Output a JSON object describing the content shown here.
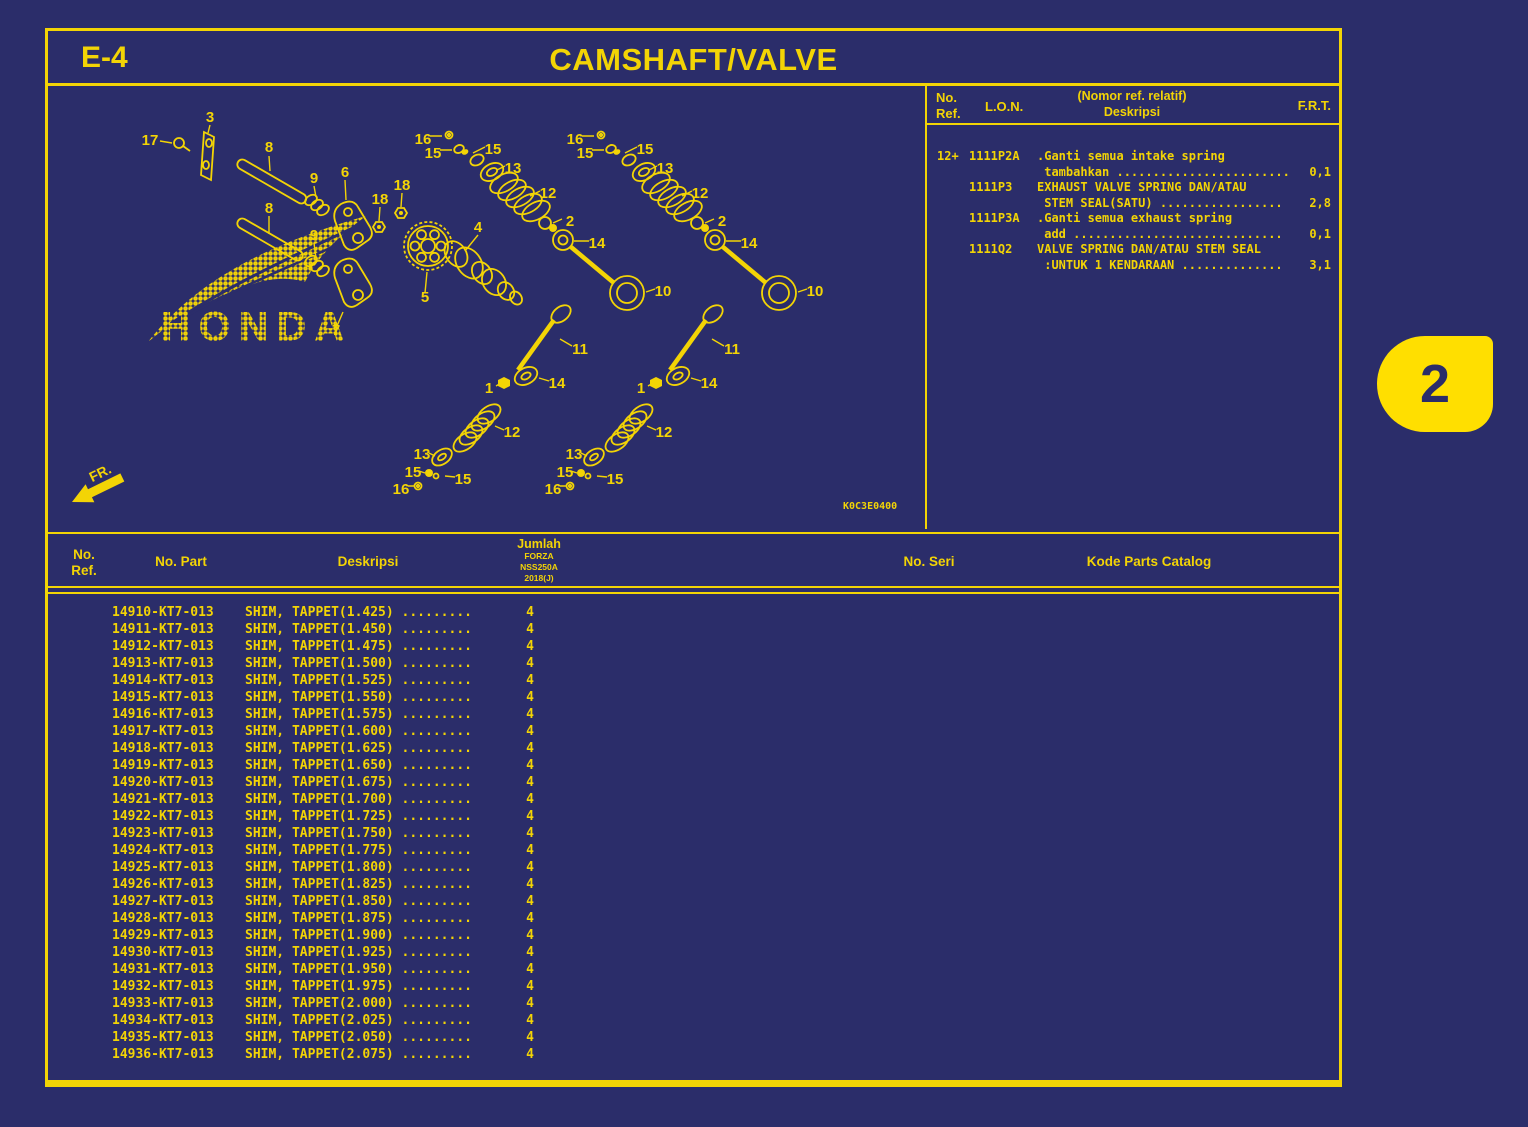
{
  "page": {
    "code": "E-4",
    "title": "CAMSHAFT/VALVE",
    "diagram_code": "K0C3E0400",
    "fr_label": "FR.",
    "tab_number": "2",
    "watermark": "HONDA"
  },
  "colors": {
    "background": "#2b2d6a",
    "line_yellow": "#f3d405",
    "tab_yellow": "#ffdf00"
  },
  "lon_table": {
    "headers": {
      "no": "No.",
      "ref": "Ref.",
      "lon": "L.O.N.",
      "desk1": "(Nomor ref. relatif)",
      "desk2": "Deskripsi",
      "frt": "F.R.T."
    },
    "rows": [
      {
        "ref": "12+",
        "lon": "1111P2A",
        "line1": ".Ganti semua intake spring",
        "line2": " tambahkan ........................",
        "frt": "0,1"
      },
      {
        "ref": "",
        "lon": "1111P3",
        "line1": "EXHAUST VALVE SPRING DAN/ATAU",
        "line2": " STEM SEAL(SATU) .................",
        "frt": "2,8"
      },
      {
        "ref": "",
        "lon": "1111P3A",
        "line1": ".Ganti semua exhaust spring",
        "line2": " add .............................",
        "frt": "0,1"
      },
      {
        "ref": "",
        "lon": "1111Q2",
        "line1": "VALVE SPRING DAN/ATAU STEM SEAL",
        "line2": " :UNTUK 1 KENDARAAN ..............",
        "frt": "3,1"
      }
    ]
  },
  "parts_table": {
    "headers": {
      "no": "No.",
      "ref": "Ref.",
      "part": "No. Part",
      "desk": "Deskripsi",
      "jumlah": "Jumlah",
      "model1": "FORZA",
      "model2": "NSS250A",
      "model3": "2018(J)",
      "seri": "No. Seri",
      "kode": "Kode Parts Catalog"
    },
    "rows": [
      {
        "part": "14910-KT7-013",
        "desc": "SHIM, TAPPET(1.425)",
        "dots": ".........",
        "qty": "4"
      },
      {
        "part": "14911-KT7-013",
        "desc": "SHIM, TAPPET(1.450)",
        "dots": ".........",
        "qty": "4"
      },
      {
        "part": "14912-KT7-013",
        "desc": "SHIM, TAPPET(1.475)",
        "dots": ".........",
        "qty": "4"
      },
      {
        "part": "14913-KT7-013",
        "desc": "SHIM, TAPPET(1.500)",
        "dots": ".........",
        "qty": "4"
      },
      {
        "part": "14914-KT7-013",
        "desc": "SHIM, TAPPET(1.525)",
        "dots": ".........",
        "qty": "4"
      },
      {
        "part": "14915-KT7-013",
        "desc": "SHIM, TAPPET(1.550)",
        "dots": ".........",
        "qty": "4"
      },
      {
        "part": "14916-KT7-013",
        "desc": "SHIM, TAPPET(1.575)",
        "dots": ".........",
        "qty": "4"
      },
      {
        "part": "14917-KT7-013",
        "desc": "SHIM, TAPPET(1.600)",
        "dots": ".........",
        "qty": "4"
      },
      {
        "part": "14918-KT7-013",
        "desc": "SHIM, TAPPET(1.625)",
        "dots": ".........",
        "qty": "4"
      },
      {
        "part": "14919-KT7-013",
        "desc": "SHIM, TAPPET(1.650)",
        "dots": ".........",
        "qty": "4"
      },
      {
        "part": "14920-KT7-013",
        "desc": "SHIM, TAPPET(1.675)",
        "dots": ".........",
        "qty": "4"
      },
      {
        "part": "14921-KT7-013",
        "desc": "SHIM, TAPPET(1.700)",
        "dots": ".........",
        "qty": "4"
      },
      {
        "part": "14922-KT7-013",
        "desc": "SHIM, TAPPET(1.725)",
        "dots": ".........",
        "qty": "4"
      },
      {
        "part": "14923-KT7-013",
        "desc": "SHIM, TAPPET(1.750)",
        "dots": ".........",
        "qty": "4"
      },
      {
        "part": "14924-KT7-013",
        "desc": "SHIM, TAPPET(1.775)",
        "dots": ".........",
        "qty": "4"
      },
      {
        "part": "14925-KT7-013",
        "desc": "SHIM, TAPPET(1.800)",
        "dots": ".........",
        "qty": "4"
      },
      {
        "part": "14926-KT7-013",
        "desc": "SHIM, TAPPET(1.825)",
        "dots": ".........",
        "qty": "4"
      },
      {
        "part": "14927-KT7-013",
        "desc": "SHIM, TAPPET(1.850)",
        "dots": ".........",
        "qty": "4"
      },
      {
        "part": "14928-KT7-013",
        "desc": "SHIM, TAPPET(1.875)",
        "dots": ".........",
        "qty": "4"
      },
      {
        "part": "14929-KT7-013",
        "desc": "SHIM, TAPPET(1.900)",
        "dots": ".........",
        "qty": "4"
      },
      {
        "part": "14930-KT7-013",
        "desc": "SHIM, TAPPET(1.925)",
        "dots": ".........",
        "qty": "4"
      },
      {
        "part": "14931-KT7-013",
        "desc": "SHIM, TAPPET(1.950)",
        "dots": ".........",
        "qty": "4"
      },
      {
        "part": "14932-KT7-013",
        "desc": "SHIM, TAPPET(1.975)",
        "dots": ".........",
        "qty": "4"
      },
      {
        "part": "14933-KT7-013",
        "desc": "SHIM, TAPPET(2.000)",
        "dots": ".........",
        "qty": "4"
      },
      {
        "part": "14934-KT7-013",
        "desc": "SHIM, TAPPET(2.025)",
        "dots": ".........",
        "qty": "4"
      },
      {
        "part": "14935-KT7-013",
        "desc": "SHIM, TAPPET(2.050)",
        "dots": ".........",
        "qty": "4"
      },
      {
        "part": "14936-KT7-013",
        "desc": "SHIM, TAPPET(2.075)",
        "dots": ".........",
        "qty": "4"
      }
    ]
  },
  "diagram": {
    "callouts": [
      {
        "t": "17",
        "x": 102,
        "y": 59
      },
      {
        "t": "3",
        "x": 162,
        "y": 36
      },
      {
        "t": "8",
        "x": 221,
        "y": 66
      },
      {
        "t": "8",
        "x": 221,
        "y": 127
      },
      {
        "t": "9",
        "x": 266,
        "y": 97
      },
      {
        "t": "9",
        "x": 266,
        "y": 154
      },
      {
        "t": "6",
        "x": 297,
        "y": 91
      },
      {
        "t": "18",
        "x": 332,
        "y": 118
      },
      {
        "t": "18",
        "x": 354,
        "y": 104
      },
      {
        "t": "7",
        "x": 288,
        "y": 249
      },
      {
        "t": "5",
        "x": 377,
        "y": 216
      },
      {
        "t": "4",
        "x": 430,
        "y": 146
      },
      {
        "t": "16",
        "x": 375,
        "y": 58
      },
      {
        "t": "15",
        "x": 385,
        "y": 72
      },
      {
        "t": "15",
        "x": 445,
        "y": 68
      },
      {
        "t": "13",
        "x": 465,
        "y": 87
      },
      {
        "t": "12",
        "x": 500,
        "y": 112
      },
      {
        "t": "2",
        "x": 522,
        "y": 140
      },
      {
        "t": "14",
        "x": 549,
        "y": 162
      },
      {
        "t": "10",
        "x": 615,
        "y": 210
      },
      {
        "t": "11",
        "x": 532,
        "y": 268
      },
      {
        "t": "14",
        "x": 509,
        "y": 302
      },
      {
        "t": "1",
        "x": 441,
        "y": 307
      },
      {
        "t": "12",
        "x": 464,
        "y": 351
      },
      {
        "t": "13",
        "x": 374,
        "y": 373
      },
      {
        "t": "15",
        "x": 365,
        "y": 391
      },
      {
        "t": "15",
        "x": 415,
        "y": 398
      },
      {
        "t": "16",
        "x": 353,
        "y": 408
      },
      {
        "t": "16",
        "x": 527,
        "y": 58
      },
      {
        "t": "15",
        "x": 537,
        "y": 72
      },
      {
        "t": "15",
        "x": 597,
        "y": 68
      },
      {
        "t": "13",
        "x": 617,
        "y": 87
      },
      {
        "t": "12",
        "x": 652,
        "y": 112
      },
      {
        "t": "2",
        "x": 674,
        "y": 140
      },
      {
        "t": "14",
        "x": 701,
        "y": 162
      },
      {
        "t": "10",
        "x": 767,
        "y": 210
      },
      {
        "t": "11",
        "x": 684,
        "y": 268
      },
      {
        "t": "14",
        "x": 661,
        "y": 302
      },
      {
        "t": "1",
        "x": 593,
        "y": 307
      },
      {
        "t": "12",
        "x": 616,
        "y": 351
      },
      {
        "t": "13",
        "x": 526,
        "y": 373
      },
      {
        "t": "15",
        "x": 517,
        "y": 391
      },
      {
        "t": "15",
        "x": 567,
        "y": 398
      },
      {
        "t": "16",
        "x": 505,
        "y": 408
      }
    ]
  }
}
